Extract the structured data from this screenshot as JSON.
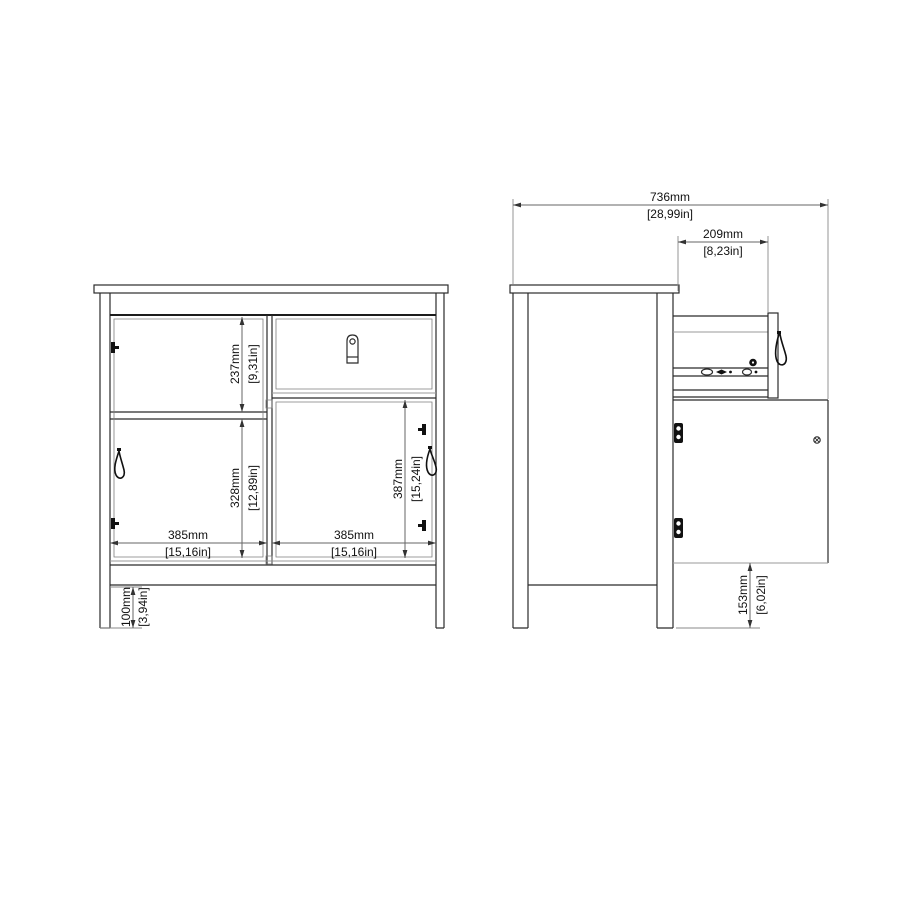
{
  "diagram": {
    "background": "#ffffff",
    "line_color": "#2b2b2b",
    "dim_line_color": "#666666",
    "dims": {
      "front_upper_left": {
        "mm": "237mm",
        "in": "[9,31in]"
      },
      "front_lower_left": {
        "mm": "328mm",
        "in": "[12,89in]"
      },
      "front_right_door": {
        "mm": "387mm",
        "in": "[15,24in]"
      },
      "front_left_width": {
        "mm": "385mm",
        "in": "[15,16in]"
      },
      "front_right_width": {
        "mm": "385mm",
        "in": "[15,16in]"
      },
      "front_leg_height": {
        "mm": "100mm",
        "in": "[3,94in]"
      },
      "side_total_depth": {
        "mm": "736mm",
        "in": "[28,99in]"
      },
      "side_drawer_ext": {
        "mm": "209mm",
        "in": "[8,23in]"
      },
      "side_door_clearance": {
        "mm": "153mm",
        "in": "[6,02in]"
      }
    }
  }
}
